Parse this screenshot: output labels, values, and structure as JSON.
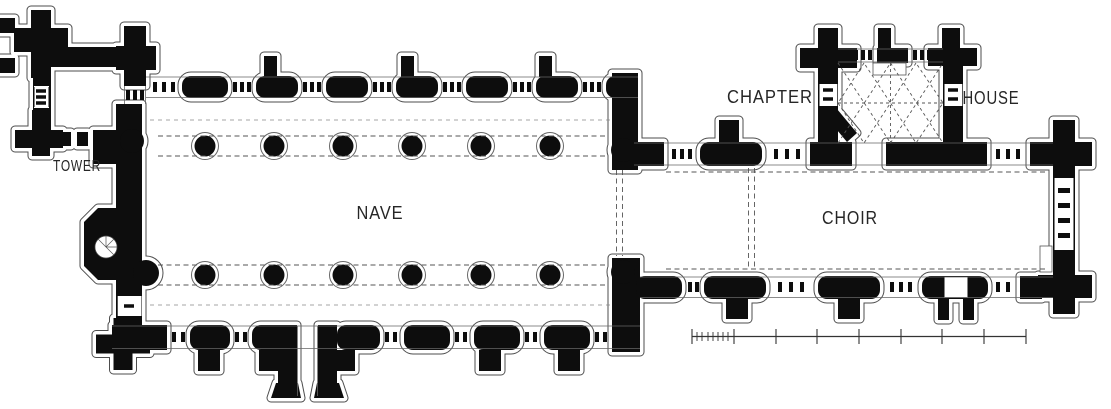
{
  "plan": {
    "type": "church-floor-plan",
    "labels": {
      "tower": "TOWER",
      "nave": "NAVE",
      "choir": "CHOIR",
      "chapter": "CHAPTER",
      "house": "HOUSE"
    }
  },
  "colors": {
    "wall": "#0d0d0d",
    "plinth_outline": "#4d4d4d",
    "face_line": "#666666",
    "dashed_line": "#555555",
    "background": "#ffffff",
    "label_text": "#262626"
  }
}
